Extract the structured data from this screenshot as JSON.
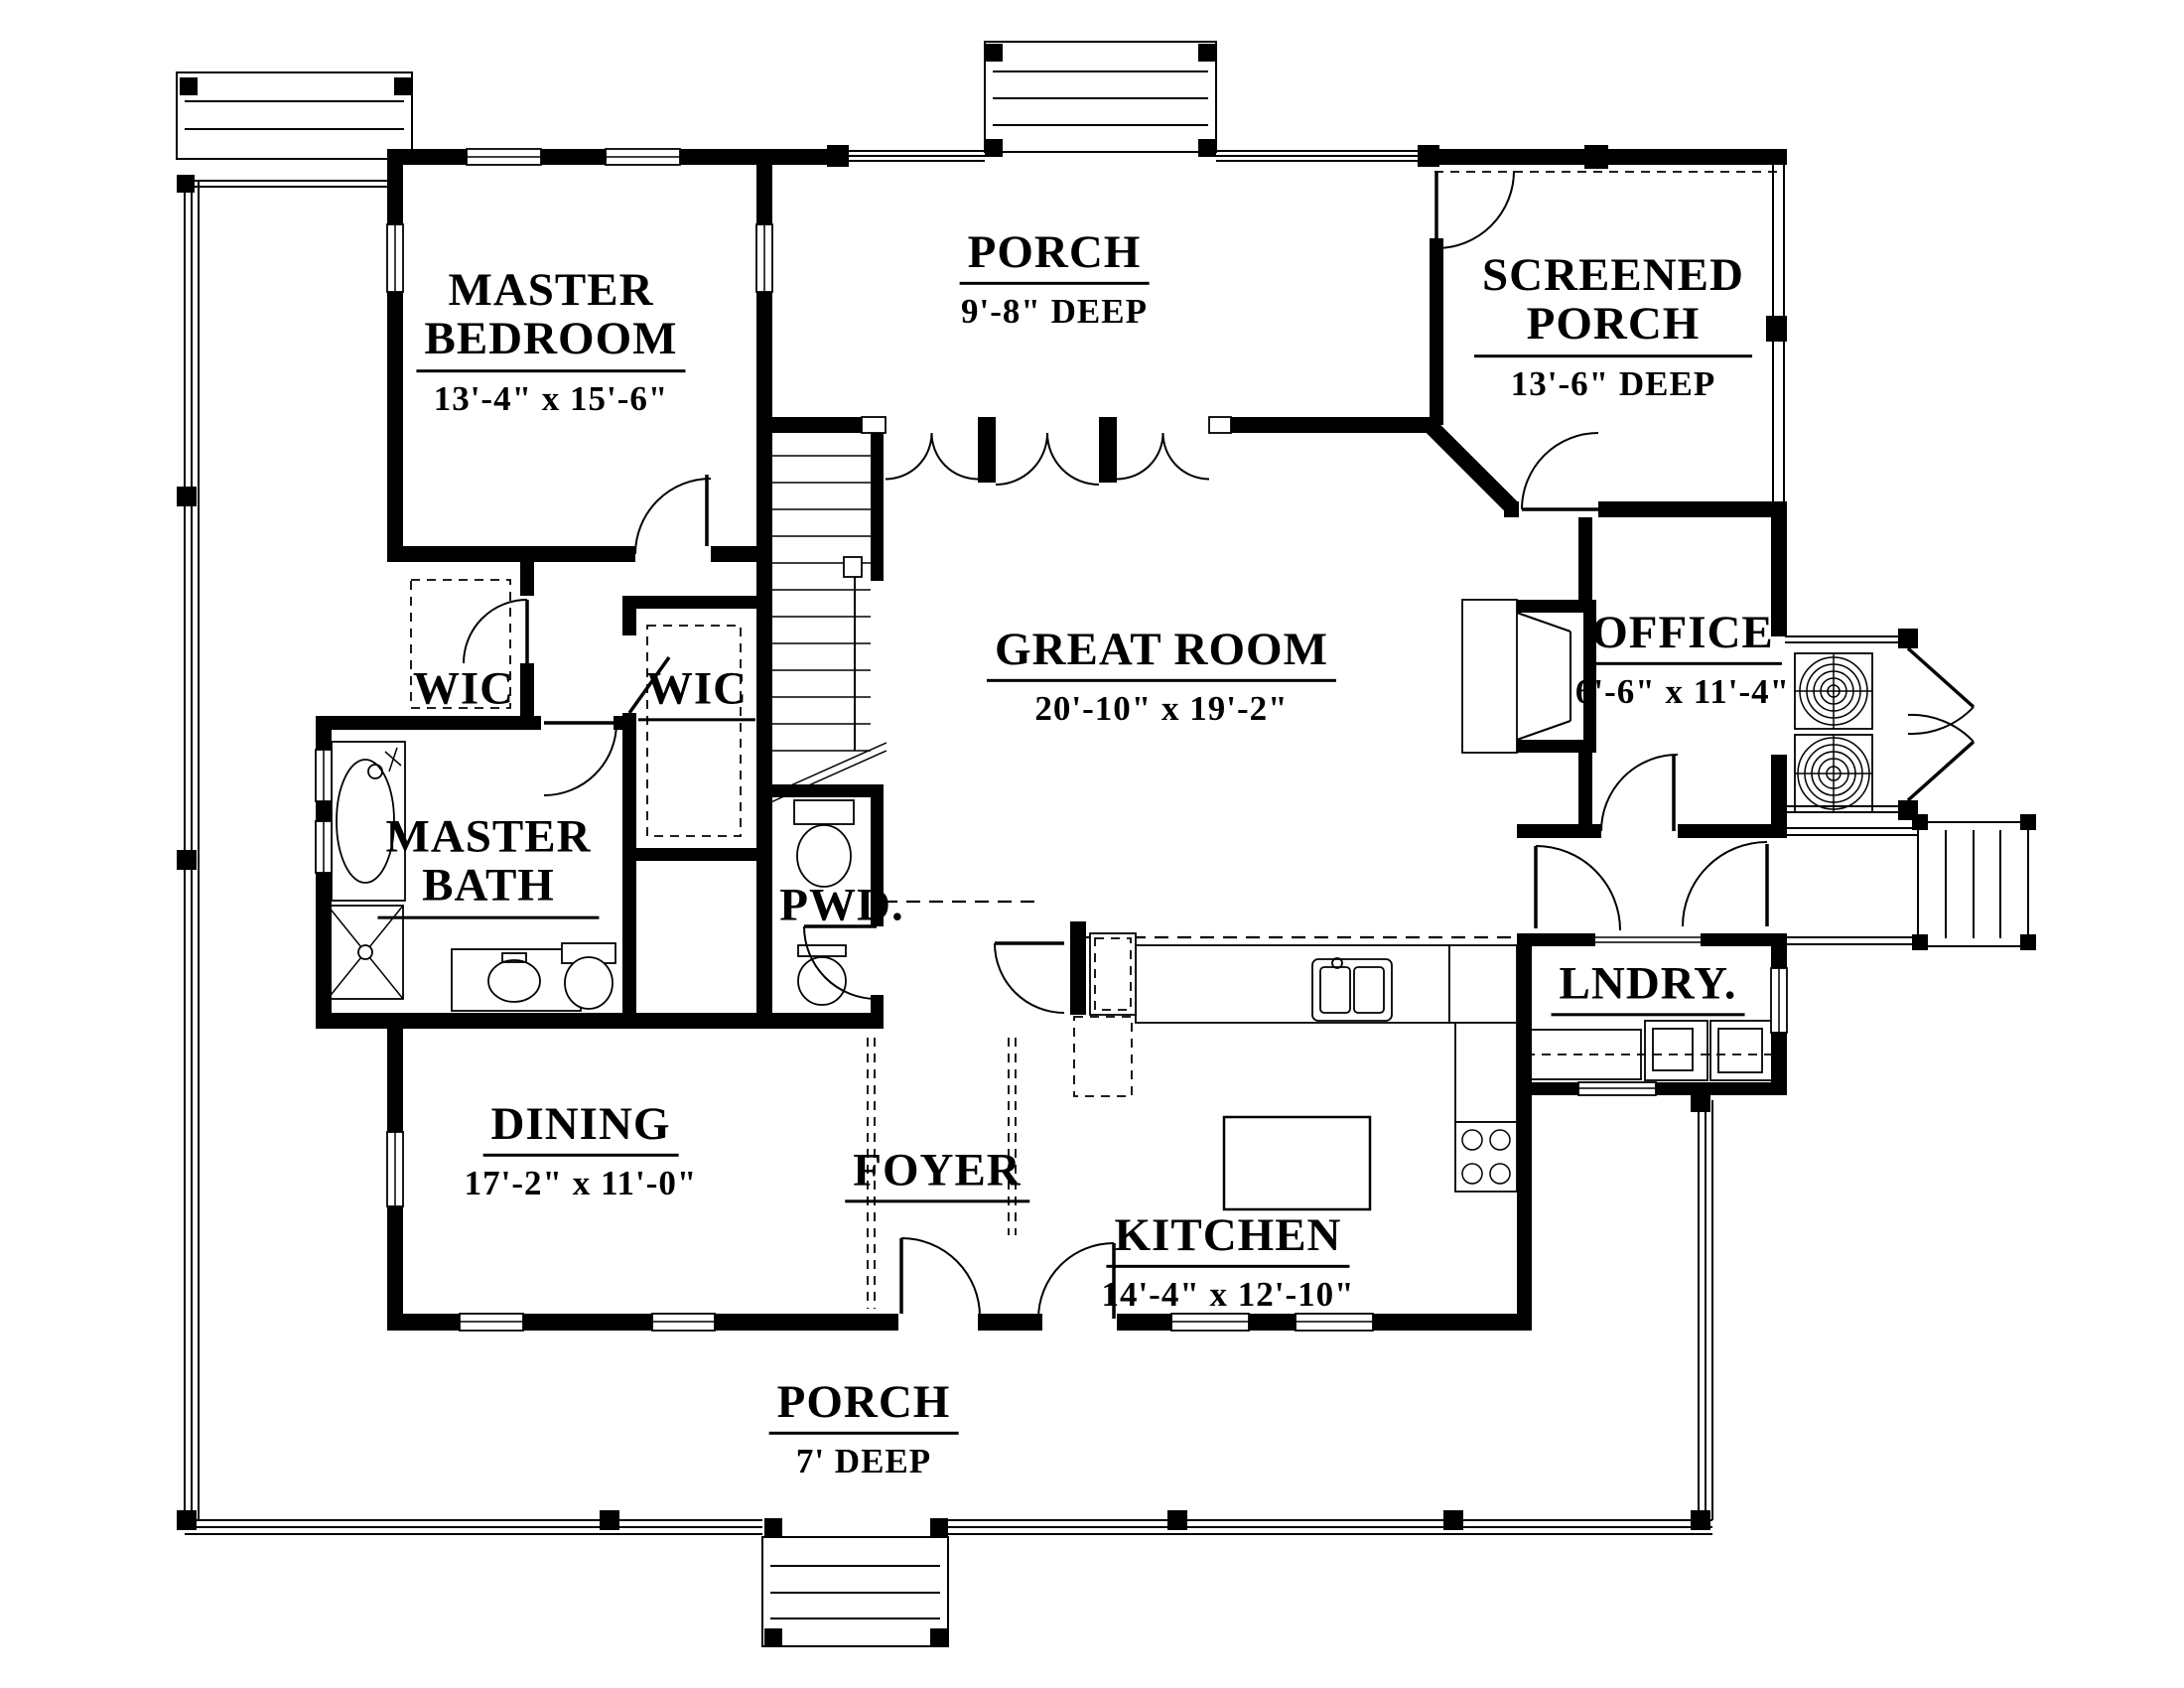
{
  "rooms": {
    "master_bedroom": {
      "line1": "MASTER",
      "line2": "BEDROOM",
      "dims": "13'-4\" x 15'-6\""
    },
    "porch_top": {
      "line1": "PORCH",
      "line2": "",
      "dims": "9'-8\" DEEP"
    },
    "screened_porch": {
      "line1": "SCREENED",
      "line2": "PORCH",
      "dims": "13'-6\" DEEP"
    },
    "wic_left": {
      "line1": "WIC",
      "line2": "",
      "dims": ""
    },
    "wic_right": {
      "line1": "WIC",
      "line2": "",
      "dims": ""
    },
    "master_bath": {
      "line1": "MASTER",
      "line2": "BATH",
      "dims": ""
    },
    "great_room": {
      "line1": "GREAT ROOM",
      "line2": "",
      "dims": "20'-10\" x 19'-2\""
    },
    "office": {
      "line1": "OFFICE",
      "line2": "",
      "dims": "6'-6\" x 11'-4\""
    },
    "powder": {
      "line1": "PWD.",
      "line2": "",
      "dims": ""
    },
    "dining": {
      "line1": "DINING",
      "line2": "",
      "dims": "17'-2\" x 11'-0\""
    },
    "foyer": {
      "line1": "FOYER",
      "line2": "",
      "dims": ""
    },
    "kitchen": {
      "line1": "KITCHEN",
      "line2": "",
      "dims": "14'-4\" x 12'-10\""
    },
    "laundry": {
      "line1": "LNDRY.",
      "line2": "",
      "dims": ""
    },
    "porch_bottom": {
      "line1": "PORCH",
      "line2": "",
      "dims": "7' DEEP"
    }
  },
  "colors": {
    "ink": "#000000",
    "paper": "#ffffff"
  }
}
